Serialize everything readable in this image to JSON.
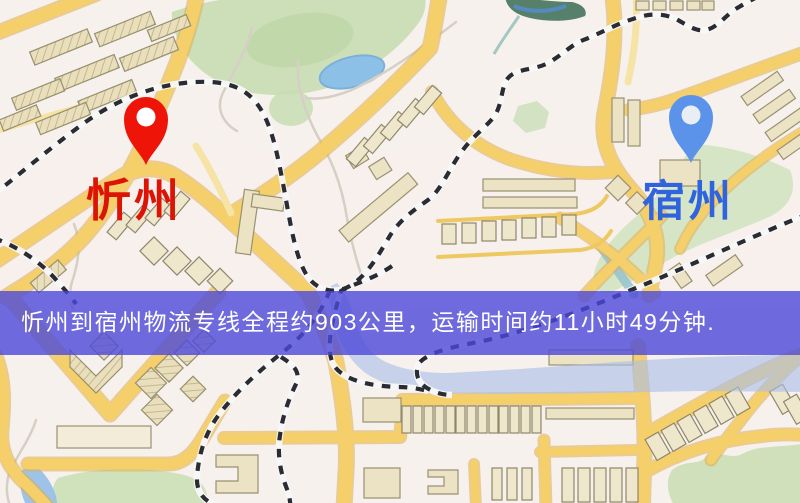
{
  "map": {
    "origin": {
      "name": "忻州",
      "pin_color": "#ee1508",
      "pin_inner_color": "#ffffff",
      "label_color": "#dd1405"
    },
    "destination": {
      "name": "宿州",
      "pin_color": "#5b93ea",
      "pin_inner_color": "#e9edf4",
      "label_color": "#3064de"
    }
  },
  "banner": {
    "text": "忻州到宿州物流专线全程约903公里，运输时间约11小时49分钟.",
    "background_color": "rgba(76,73,218,0.80)",
    "text_color": "#ffffff"
  },
  "route": {
    "origin": "忻州",
    "destination": "宿州",
    "distance_text": "约903公里",
    "duration_text": "约11小时49分钟"
  },
  "map_colors": {
    "background": "#f6f1ec",
    "road_major": "#f4cf6a",
    "road_casing": "#e0ad4e",
    "road_minor": "#f6e3a6",
    "building": "#ece2c4",
    "green_area": "#ccdfb8",
    "water": "#8cc0e6",
    "river": "#a9bfe8",
    "railway": "#2b2b33"
  }
}
